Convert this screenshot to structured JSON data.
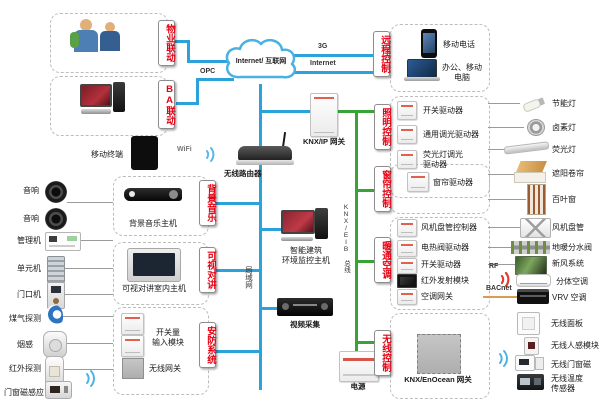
{
  "colors": {
    "bus_lan": "#2ba2da",
    "bus_knx": "#38a437",
    "accent_red": "#e60012",
    "bacnet_line": "#d99c55"
  },
  "top": {
    "property": "物业联动",
    "ba": "BA联动",
    "opc": "OPC",
    "cloud": "Internet/ 互联网",
    "g3": "3G",
    "internet": "Internet",
    "remote_label": "远程控制",
    "phone": "移动电话",
    "computer": "办公、移动\n电脑"
  },
  "core": {
    "knx_ip_gateway": "KNX/IP 网关",
    "router": "无线路由器",
    "wifi": "WiFi",
    "mobile_terminal": "移动终端",
    "lan": "局域网",
    "bus": "KNX/EIB 总线",
    "monitor_host": "智能建筑\n环境监控主机",
    "video_capture": "视频采集",
    "power": "电源"
  },
  "left": {
    "speaker1": "音响",
    "speaker2": "音响",
    "bgm_label": "背景音乐",
    "bgm_host": "背景音乐主机",
    "intercom_label": "可视对讲",
    "intercom_host": "可视对讲室内主机",
    "manager": "管理机",
    "unit": "单元机",
    "door": "门口机",
    "security_label": "安防系统",
    "gas": "煤气探测",
    "smoke": "烟感",
    "pir": "红外探测",
    "door_magnet": "门窗磁感应",
    "input_module": "开关量\n输入模块",
    "wireless_gateway": "无线网关"
  },
  "right": {
    "lighting_label": "照明控制",
    "lighting_drivers": [
      "开关驱动器",
      "通用调光驱动器",
      "荧光灯调光\n驱动器"
    ],
    "lighting_loads": [
      "节能灯",
      "卤素灯",
      "荧光灯"
    ],
    "curtain_label": "窗帘控制",
    "curtain_driver": "窗帘驱动器",
    "curtain_loads": [
      "遮阳卷帘",
      "百叶窗"
    ],
    "hvac_label": "暖通空调",
    "hvac_drivers": [
      "风机盘管控制器",
      "电热阀驱动器",
      "开关驱动器",
      "红外发射模块",
      "空调网关"
    ],
    "hvac_loads": [
      "风机盘管",
      "地暖分水阀",
      "新风系统",
      "分体空调",
      "VRV 空调"
    ],
    "rf": "RF",
    "bacnet": "BACnet",
    "wireless_label": "无线控制",
    "enocean_gateway": "KNX/EnOcean 网关",
    "wireless_loads": [
      "无线面板",
      "无线人感模块",
      "无线门窗磁",
      "无线温度\n传感器"
    ]
  }
}
